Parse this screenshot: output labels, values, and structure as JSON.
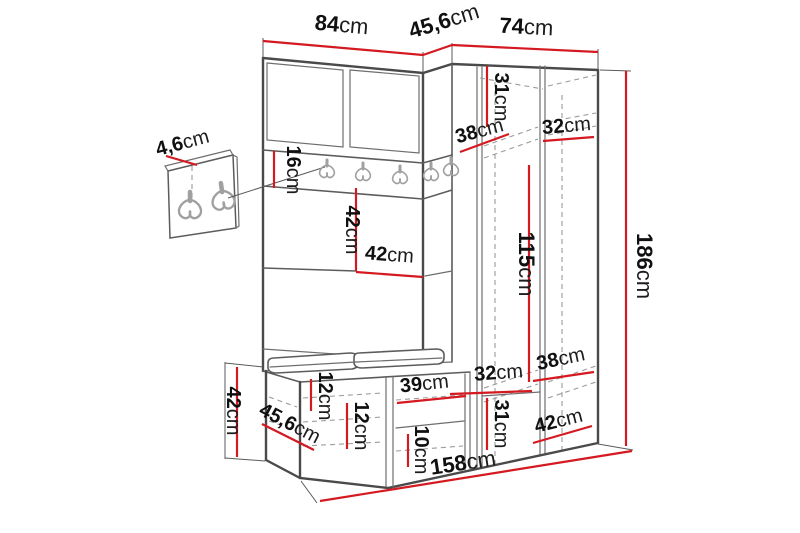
{
  "meta": {
    "unit": "cm",
    "dimension_line_color": "#d51920",
    "drawing_line_color": "#4a4a4a",
    "background_color": "#ffffff"
  },
  "dimensions": {
    "width_left": {
      "value": "84",
      "unit": "cm"
    },
    "depth_top": {
      "value": "45,6",
      "unit": "cm"
    },
    "width_right": {
      "value": "74",
      "unit": "cm"
    },
    "top_compartment_height": {
      "value": "31",
      "unit": "cm"
    },
    "top_shelf_depth": {
      "value": "38",
      "unit": "cm"
    },
    "top_shelf_width": {
      "value": "32",
      "unit": "cm"
    },
    "panel_thickness": {
      "value": "4,6",
      "unit": "cm"
    },
    "rail_height": {
      "value": "16",
      "unit": "cm"
    },
    "niche_height": {
      "value": "42",
      "unit": "cm"
    },
    "niche_width": {
      "value": "42",
      "unit": "cm"
    },
    "hanging_height": {
      "value": "115",
      "unit": "cm"
    },
    "total_height": {
      "value": "186",
      "unit": "cm"
    },
    "bench_height": {
      "value": "42",
      "unit": "cm"
    },
    "bench_depth": {
      "value": "45,6",
      "unit": "cm"
    },
    "bench_shelf_1": {
      "value": "12",
      "unit": "cm"
    },
    "bench_shelf_2": {
      "value": "12",
      "unit": "cm"
    },
    "shoe_compartment_width": {
      "value": "39",
      "unit": "cm"
    },
    "shoe_shelf_height": {
      "value": "10",
      "unit": "cm"
    },
    "bottom_shelf_width": {
      "value": "32",
      "unit": "cm"
    },
    "bottom_compartment_height": {
      "value": "31",
      "unit": "cm"
    },
    "bottom_shelf_depth": {
      "value": "38",
      "unit": "cm"
    },
    "bottom_right_depth": {
      "value": "42",
      "unit": "cm"
    },
    "total_width": {
      "value": "158",
      "unit": "cm"
    }
  }
}
